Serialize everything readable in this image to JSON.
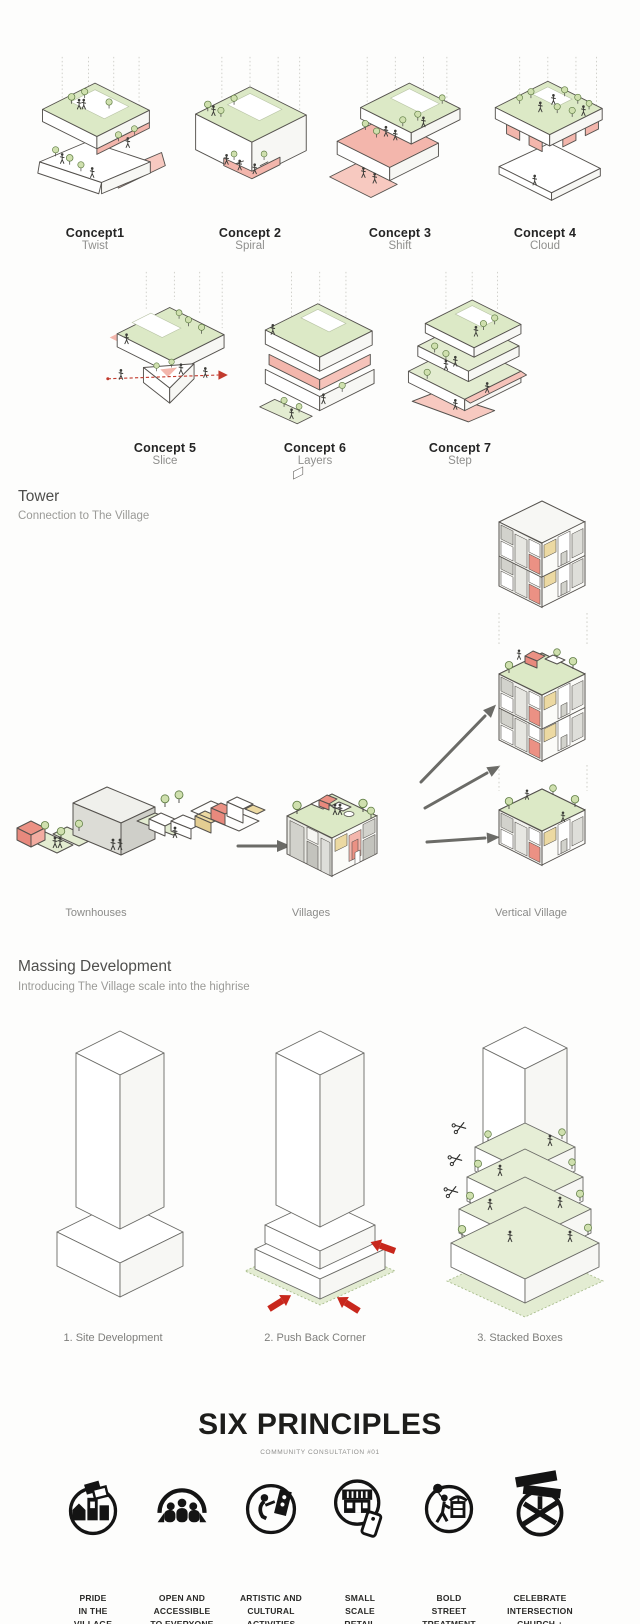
{
  "colors": {
    "roof_green": "#dce9c6",
    "accent_pink": "#f3b6ac",
    "accent_red": "#eb9184",
    "accent_yellow": "#ecd9a2",
    "arrow_red": "#c8271c",
    "arrow_gray": "#6b6b67",
    "ink": "#1d1d1b",
    "muted": "#8f8f8d"
  },
  "concepts": {
    "items": [
      {
        "name": "Concept1",
        "subtitle": "Twist"
      },
      {
        "name": "Concept 2",
        "subtitle": "Spiral"
      },
      {
        "name": "Concept 3",
        "subtitle": "Shift"
      },
      {
        "name": "Concept 4",
        "subtitle": "Cloud"
      },
      {
        "name": "Concept 5",
        "subtitle": "Slice"
      },
      {
        "name": "Concept 6",
        "subtitle": "Layers"
      },
      {
        "name": "Concept 7",
        "subtitle": "Step"
      }
    ]
  },
  "tower": {
    "title": "Tower",
    "subtitle": "Connection to The Village",
    "stages": [
      {
        "label": "Townhouses"
      },
      {
        "label": "Villages"
      },
      {
        "label": "Vertical Village"
      }
    ]
  },
  "massing": {
    "title": "Massing Development",
    "subtitle": "Introducing The Village scale into the highrise",
    "steps": [
      {
        "label": "1. Site Development"
      },
      {
        "label": "2. Push Back Corner"
      },
      {
        "label": "3. Stacked Boxes"
      }
    ]
  },
  "principles": {
    "title": "SIX PRINCIPLES",
    "subtitle": "COMMUNITY CONSULTATION #01",
    "items": [
      {
        "label": "PRIDE\nIN THE\nVILLAGE",
        "icon": "village-pride-icon"
      },
      {
        "label": "OPEN AND\nACCESSIBLE\nTO EVERYONE",
        "icon": "open-accessible-icon"
      },
      {
        "label": "ARTISTIC AND\nCULTURAL\nACTIVITIES",
        "icon": "artistic-cultural-icon"
      },
      {
        "label": "SMALL\nSCALE\nRETAIL",
        "icon": "small-retail-icon"
      },
      {
        "label": "BOLD\nSTREET\nTREATMENT",
        "icon": "bold-street-icon"
      },
      {
        "label": "CELEBRATE\nINTERSECTION\nCHURCH +\nWELLESLEY",
        "icon": "celebrate-intersection-icon"
      }
    ]
  }
}
